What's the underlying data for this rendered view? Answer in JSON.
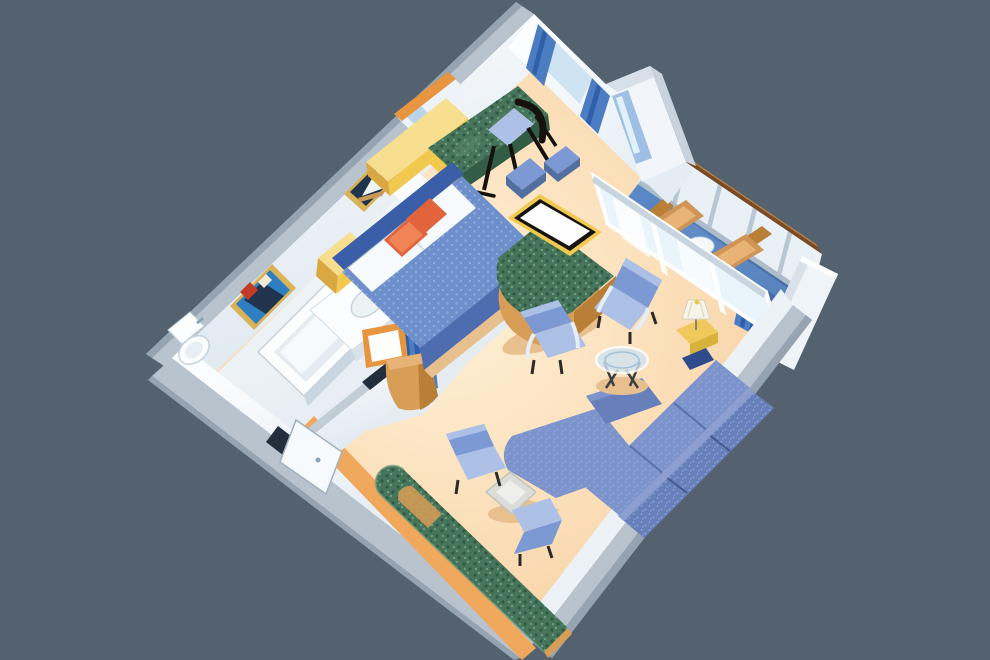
{
  "scene": {
    "type": "isometric-cutaway-floorplan",
    "subject": "cruise-ship-grand-suite",
    "view": "three-quarter overhead, rotated diamond orientation",
    "rooms": {
      "bedroom": {
        "furniture": [
          "queen-bed",
          "headboard",
          "white-pillows",
          "orange-accent-pillows",
          "nightstand",
          "vanity-desk-with-mirror",
          "green-daybed-bench",
          "black-desk-chair",
          "framed-sailboat-picture",
          "blue-ottoman",
          "blue-ottoman"
        ]
      },
      "bathroom": {
        "furniture": [
          "bathtub",
          "sink-counter",
          "toilet",
          "framed-maritime-painting",
          "towel-bar"
        ]
      },
      "dressing-nook": {
        "furniture": [
          "blue-pleated-curtain",
          "orange-framed-mirror",
          "tan-round-cabinet"
        ]
      },
      "living-room": {
        "furniture": [
          "l-shaped-sectional-sofa",
          "armchair",
          "armchair",
          "tub-chair",
          "tub-chair",
          "glass-coffee-table",
          "gray-side-table",
          "lamp-side-table",
          "table-lamp",
          "navy-stool",
          "green-curved-window-bench",
          "tv-cabinet",
          "television"
        ]
      },
      "balcony": {
        "furniture": [
          "deck-lounger",
          "deck-lounger",
          "round-deck-table",
          "railing-with-wood-cap",
          "privacy-partition",
          "sliding-glass-doors",
          "blue-curtain"
        ]
      },
      "entry": {
        "furniture": [
          "entry-door"
        ]
      }
    }
  },
  "palette": {
    "background": "#54626F",
    "wall_top": "#B9C3CE",
    "wall_top_dark": "#96A3B1",
    "wall_face": "#FFFFFF",
    "wall_face_shade": "#DCE6EF",
    "carpet": "#F8D3A5",
    "carpet_light": "#FEF0D6",
    "carpet_shadow": "#E8C08E",
    "bath_floor": "#F2F6F9",
    "fixture_white": "#FBFDFE",
    "fixture_shade": "#E4ECF2",
    "fixture_rim": "#C6D2DB",
    "bedspread": "#6D8FCC",
    "bedspread_dark": "#4E6DB0",
    "bed_dot": "#94ACDD",
    "headboard": "#3A5EA8",
    "pillow": "#F7FAFD",
    "orange_pillow": "#E2643C",
    "orange_pillow_light": "#F08457",
    "wood_yellow": "#F2C94F",
    "wood_yellow_light": "#F8DF8F",
    "wood_yellow_dark": "#D9A843",
    "wood_tan": "#D99E55",
    "wood_tan_dark": "#B97F36",
    "orange_rail": "#E8953F",
    "green_uph": "#47755B",
    "green_uph_dark": "#335C45",
    "green_dot_dark": "#2E5A41",
    "green_dot_light": "#6FA183",
    "tv_black": "#17140F",
    "tv_screen": "#FEFEFE",
    "chair_blue": "#7C99D4",
    "chair_blue_light": "#ADC1E6",
    "chair_blue_dark": "#52709F",
    "sofa_blue": "#6780BC",
    "sofa_seat": "#7D93CC",
    "sofa_dark": "#46598F",
    "sofa_dot": "#93A5D6",
    "black_chair": "#15110C",
    "curtain_blue": "#4C7CC2",
    "curtain_blue_dark": "#2F5FA8",
    "glass": "#CFE4F2",
    "glass_light": "#E9F4FB",
    "balcony_floor": "#4C7FC4",
    "balcony_floor_light": "#6F9AD4",
    "rail_wood": "#7B4A22",
    "rail_wood_light": "#B5824C",
    "rail_panel": "#E9F0F6",
    "rail_post": "#B9C7D4",
    "lounger_tan": "#D09555",
    "lounger_tan_light": "#E8B377",
    "lamp_yellow": "#EFC95B",
    "lamp_shade": "#F7F4EA",
    "table_gray": "#DCDDD9",
    "art_gold": "#D9B356",
    "art_blue": "#2E7FC2",
    "art_navy": "#20344E",
    "art_red": "#C43B2A",
    "door_dark": "#222E3C",
    "navy_stool": "#2E4B8E",
    "vase_green": "#6B8F4A"
  }
}
